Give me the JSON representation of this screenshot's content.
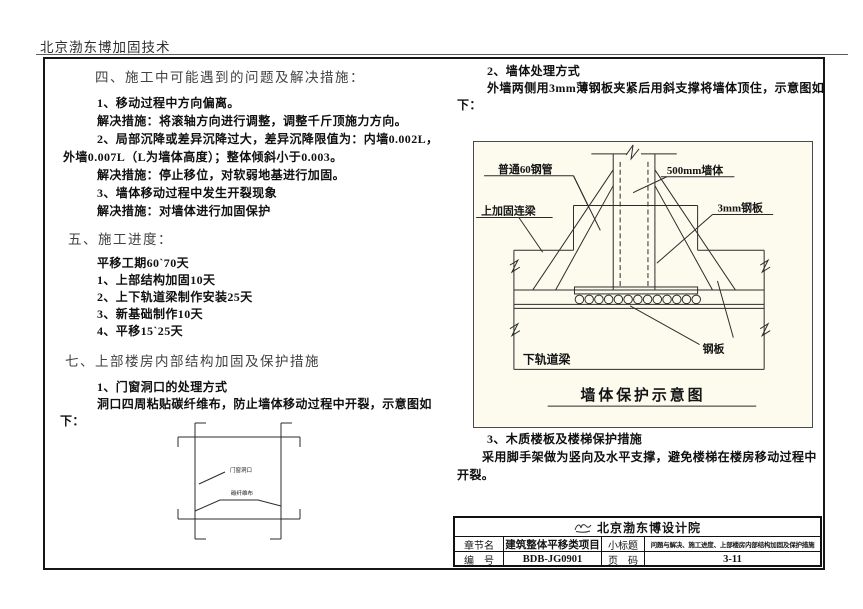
{
  "page": {
    "header": "北京渤东博加固技术"
  },
  "left": {
    "s4_title": "四、施工中可能遇到的问题及解决措施：",
    "s4_lines": [
      "1、移动过程中方向偏离。",
      "解决措施：将滚轴方向进行调整，调整千斤顶施力方向。",
      "2、局部沉降或差异沉降过大，差异沉降限值为：内墙0.002L，",
      "外墙0.007L（L为墙体高度）；整体倾斜小于0.003。",
      "解决措施：停止移位，对软弱地基进行加固。",
      "3、墙体移动过程中发生开裂现象",
      "解决措施：对墙体进行加固保护"
    ],
    "s5_title": "五、施工进度：",
    "s5_lines": [
      "平移工期60`70天",
      "1、上部结构加固10天",
      "2、上下轨道梁制作安装25天",
      "3、新基础制作10天",
      "4、平移15`25天"
    ],
    "s7_title": "七、上部楼房内部结构加固及保护措施",
    "s7_lines": [
      "1、门窗洞口的处理方式",
      "洞口四周粘贴碳纤维布，防止墙体移动过程中开裂，示意图如",
      "下："
    ],
    "opening_diagram": {
      "label_opening": "门窗洞口",
      "label_cfrp": "碳纤维布"
    }
  },
  "right": {
    "s2_lines": [
      "2、墙体处理方式",
      "外墙两侧用3mm薄钢板夹紧后用斜支撑将墙体顶住，示意图如",
      "下："
    ],
    "wall_diagram": {
      "label_pipe": "普通60钢管",
      "label_wall": "500mm墙体",
      "label_beam": "上加固连梁",
      "label_plate3": "3mm钢板",
      "label_plate": "钢板",
      "label_track": "下轨道梁",
      "caption": "墙体保护示意图"
    },
    "s3_lines": [
      "3、木质楼板及楼梯保护措施",
      "采用脚手架做为竖向及水平支撑，避免楼梯在楼房移动过程中",
      "开裂。"
    ]
  },
  "titleblock": {
    "company": "北京渤东博设计院",
    "chapter_label": "章节名",
    "chapter_value": "建筑整体平移类项目",
    "subtitle_label": "小标题",
    "subtitle_value": "问题与解决、施工进度、上部楼房内部结构加固及保护措施",
    "number_label": "编　号",
    "number_value": "BDB-JG0901",
    "page_label": "页　码",
    "page_value": "3-11"
  }
}
